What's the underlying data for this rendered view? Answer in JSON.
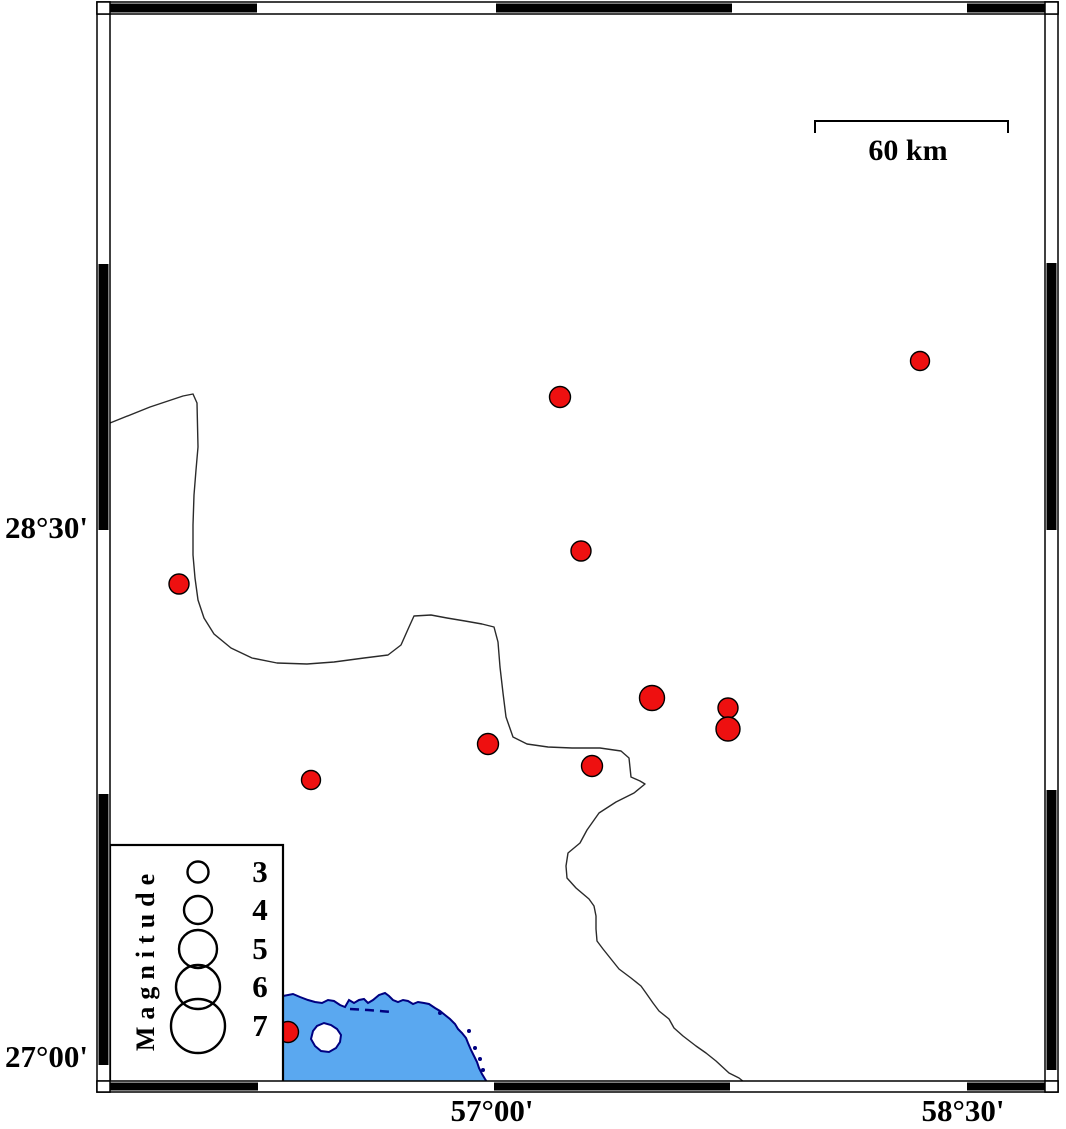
{
  "colors": {
    "background": "#ffffff",
    "epicenter": "#ee1010",
    "epicenter_outline": "#000000",
    "sea": "#5aa8f0",
    "coast": "#000080",
    "boundary": "#2a2a2a",
    "frame_black": "#000000",
    "frame_white": "#ffffff"
  },
  "axis": {
    "lat": [
      {
        "label": "28°30'"
      },
      {
        "label": "27°00'"
      }
    ],
    "lon": [
      {
        "label": "57°00'"
      },
      {
        "label": "58°30'"
      }
    ]
  },
  "scalebar": {
    "label": "60 km",
    "x1": 815,
    "x2": 1008,
    "y": 121,
    "tick": 12
  },
  "legend": {
    "title": "Magnitude",
    "box": {
      "x": 110,
      "y": 845,
      "w": 173,
      "h": 237
    },
    "circle_cx": 198,
    "entries": [
      {
        "label": "3",
        "cy": 872,
        "r": 10.5
      },
      {
        "label": "4",
        "cy": 910,
        "r": 14
      },
      {
        "label": "5",
        "cy": 949,
        "r": 19
      },
      {
        "label": "6",
        "cy": 987,
        "r": 22
      },
      {
        "label": "7",
        "cy": 1026,
        "r": 27
      }
    ]
  },
  "frame": {
    "x0": 97,
    "x1": 1058,
    "y0": 2,
    "y1": 1092,
    "left": {
      "x": 97,
      "w": 13
    },
    "right": {
      "x": 1045,
      "w": 13
    },
    "top": {
      "y": 2,
      "h": 12
    },
    "bottom": {
      "y": 1081,
      "h": 11
    },
    "black_segments": {
      "top": [
        [
          103,
          257
        ],
        [
          496,
          732
        ],
        [
          967,
          1045
        ]
      ],
      "bottom": [
        [
          103,
          258
        ],
        [
          494,
          730
        ],
        [
          967,
          1045
        ]
      ],
      "left": [
        [
          264,
          530
        ],
        [
          794,
          1065
        ]
      ],
      "right": [
        [
          263,
          530
        ],
        [
          790,
          1070
        ]
      ]
    }
  },
  "map": {
    "epicenters": [
      {
        "x": 920,
        "y": 361,
        "r": 9.5
      },
      {
        "x": 560,
        "y": 397,
        "r": 10.5
      },
      {
        "x": 581,
        "y": 551,
        "r": 10
      },
      {
        "x": 179,
        "y": 584,
        "r": 10
      },
      {
        "x": 652,
        "y": 698,
        "r": 12.5
      },
      {
        "x": 728,
        "y": 708,
        "r": 10
      },
      {
        "x": 728,
        "y": 729,
        "r": 12
      },
      {
        "x": 488,
        "y": 744,
        "r": 10.5
      },
      {
        "x": 592,
        "y": 766,
        "r": 10.5
      },
      {
        "x": 311,
        "y": 780,
        "r": 9.5
      },
      {
        "x": 288,
        "y": 1032,
        "r": 10.5
      }
    ],
    "boundary_line": [
      [
        110,
        423
      ],
      [
        150,
        407
      ],
      [
        183,
        396
      ],
      [
        193,
        394
      ],
      [
        197,
        403
      ],
      [
        198,
        447
      ],
      [
        196,
        470
      ],
      [
        194,
        495
      ],
      [
        193,
        525
      ],
      [
        193,
        555
      ],
      [
        195,
        578
      ],
      [
        198,
        600
      ],
      [
        204,
        618
      ],
      [
        214,
        634
      ],
      [
        231,
        648
      ],
      [
        252,
        658
      ],
      [
        277,
        663
      ],
      [
        307,
        664
      ],
      [
        334,
        662
      ],
      [
        364,
        658
      ],
      [
        388,
        655
      ],
      [
        401,
        645
      ],
      [
        409,
        627
      ],
      [
        414,
        616
      ],
      [
        431,
        615
      ],
      [
        447,
        618
      ],
      [
        465,
        621
      ],
      [
        482,
        624
      ],
      [
        494,
        627
      ],
      [
        498,
        642
      ],
      [
        500,
        667
      ],
      [
        503,
        693
      ],
      [
        506,
        717
      ],
      [
        513,
        737
      ],
      [
        527,
        744
      ],
      [
        548,
        747
      ],
      [
        572,
        748
      ],
      [
        600,
        748
      ],
      [
        621,
        751
      ],
      [
        629,
        758
      ],
      [
        631,
        777
      ],
      [
        640,
        781
      ],
      [
        645,
        784
      ],
      [
        634,
        793
      ],
      [
        616,
        802
      ],
      [
        599,
        813
      ],
      [
        587,
        830
      ],
      [
        580,
        843
      ],
      [
        568,
        853
      ],
      [
        566,
        866
      ],
      [
        567,
        878
      ],
      [
        576,
        888
      ],
      [
        589,
        899
      ],
      [
        594,
        906
      ],
      [
        596,
        916
      ],
      [
        596,
        929
      ],
      [
        597,
        941
      ],
      [
        603,
        949
      ],
      [
        611,
        959
      ],
      [
        619,
        969
      ],
      [
        631,
        978
      ],
      [
        641,
        986
      ],
      [
        646,
        993
      ],
      [
        653,
        1003
      ],
      [
        659,
        1011
      ],
      [
        669,
        1019
      ],
      [
        674,
        1028
      ],
      [
        683,
        1036
      ],
      [
        696,
        1046
      ],
      [
        706,
        1053
      ],
      [
        716,
        1061
      ],
      [
        729,
        1073
      ],
      [
        739,
        1078
      ],
      [
        744,
        1082
      ]
    ],
    "sea_polygon": [
      [
        283,
        996
      ],
      [
        293,
        994
      ],
      [
        300,
        997
      ],
      [
        308,
        1000
      ],
      [
        315,
        1002
      ],
      [
        322,
        1003
      ],
      [
        328,
        1000
      ],
      [
        334,
        1001
      ],
      [
        340,
        1005
      ],
      [
        345,
        1007
      ],
      [
        349,
        1000
      ],
      [
        354,
        1003
      ],
      [
        359,
        1000
      ],
      [
        364,
        999
      ],
      [
        368,
        1003
      ],
      [
        373,
        1000
      ],
      [
        379,
        995
      ],
      [
        385,
        993
      ],
      [
        389,
        996
      ],
      [
        393,
        1000
      ],
      [
        398,
        1002
      ],
      [
        403,
        1000
      ],
      [
        408,
        1001
      ],
      [
        413,
        1004
      ],
      [
        418,
        1002
      ],
      [
        424,
        1003
      ],
      [
        429,
        1004
      ],
      [
        435,
        1008
      ],
      [
        440,
        1011
      ],
      [
        445,
        1015
      ],
      [
        450,
        1019
      ],
      [
        455,
        1024
      ],
      [
        458,
        1029
      ],
      [
        462,
        1033
      ],
      [
        466,
        1038
      ],
      [
        468,
        1043
      ],
      [
        471,
        1050
      ],
      [
        474,
        1056
      ],
      [
        477,
        1062
      ],
      [
        479,
        1068
      ],
      [
        482,
        1074
      ],
      [
        485,
        1079
      ],
      [
        487,
        1082
      ],
      [
        283,
        1082
      ]
    ],
    "coast_dashes": [
      [
        350,
        1009
      ],
      [
        368,
        1010
      ],
      [
        392,
        1012
      ]
    ],
    "island": [
      [
        313,
        1031
      ],
      [
        317,
        1026
      ],
      [
        324,
        1023
      ],
      [
        331,
        1025
      ],
      [
        337,
        1029
      ],
      [
        341,
        1035
      ],
      [
        340,
        1042
      ],
      [
        336,
        1048
      ],
      [
        329,
        1052
      ],
      [
        321,
        1051
      ],
      [
        315,
        1046
      ],
      [
        311,
        1039
      ]
    ],
    "islets": [
      [
        440,
        1013
      ],
      [
        469,
        1031
      ],
      [
        475,
        1048
      ],
      [
        480,
        1059
      ],
      [
        483,
        1070
      ]
    ]
  }
}
